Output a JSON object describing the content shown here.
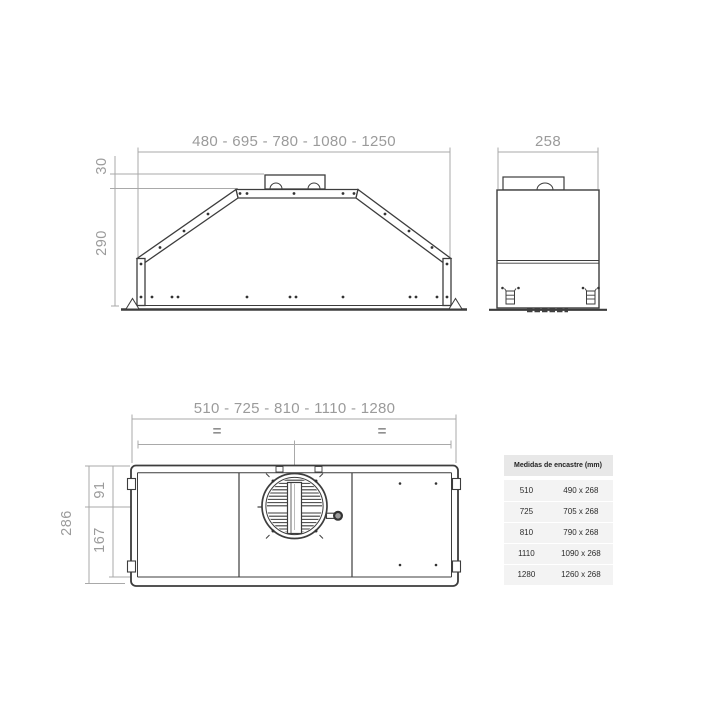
{
  "drawing": {
    "front_view": {
      "width_label": "480 - 695 - 780 - 1080 - 1250",
      "duct_height_label": "30",
      "height_label": "290"
    },
    "side_view": {
      "depth_label": "258"
    },
    "bottom_view": {
      "width_label": "510 - 725 - 810 - 1110 - 1280",
      "height_label": "286",
      "fan_offset_top_label": "91",
      "fan_offset_bottom_label": "167",
      "equal_spacing_left": "=",
      "equal_spacing_right": "="
    }
  },
  "table": {
    "title": "Medidas de encastre (mm)",
    "rows": [
      {
        "width": "510",
        "size": "490 x 268"
      },
      {
        "width": "725",
        "size": "705 x 268"
      },
      {
        "width": "810",
        "size": "790 x 268"
      },
      {
        "width": "1110",
        "size": "1090 x 268"
      },
      {
        "width": "1280",
        "size": "1260 x 268"
      }
    ]
  },
  "colors": {
    "background": "#ffffff",
    "drawing_line": "#3d3d3d",
    "dimension_line": "#a9a9a9",
    "dimension_text": "#9b9b9b",
    "table_header_bg": "#e8e8e8",
    "table_body_bg": "#f3f3f3",
    "table_text": "#2b2b2b"
  }
}
